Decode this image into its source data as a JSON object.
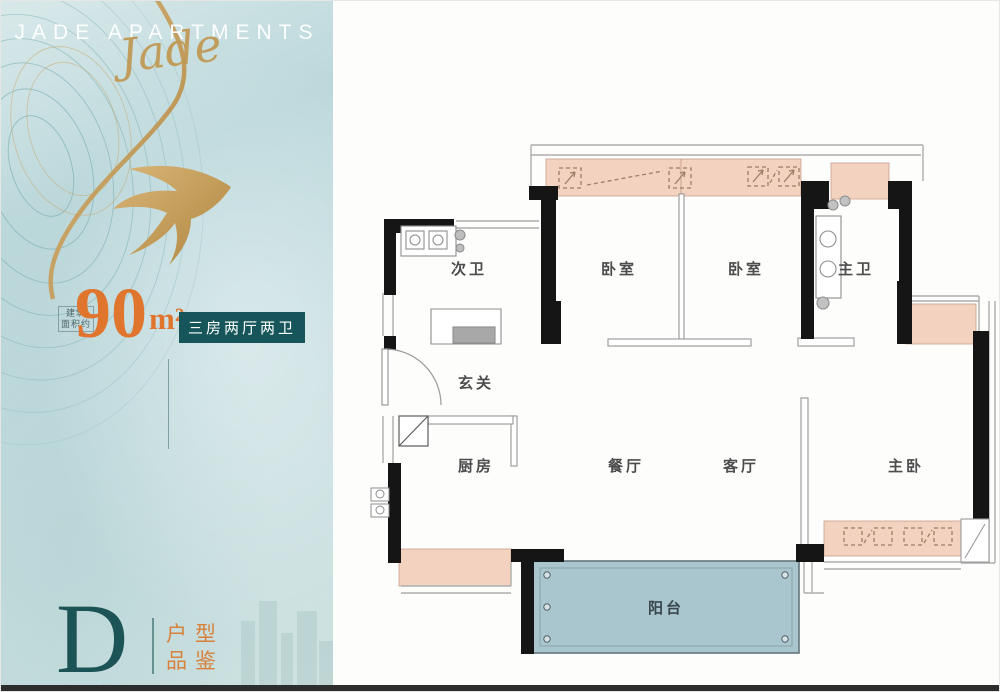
{
  "brand": {
    "title": "JADE APARTMENTS",
    "script": "Jade"
  },
  "area": {
    "prefix": [
      "建筑",
      "面积约"
    ],
    "value": "90",
    "unit": "m²",
    "badge": "三房两厅两卫"
  },
  "unit_card": {
    "letter": "D",
    "label_line1": "户型",
    "label_line2": "品鉴"
  },
  "footnote": "大平层横厅景观阳台，悦享优雅通透格局",
  "plan": {
    "room_labels": [
      "次卫",
      "卧室",
      "卧室",
      "主卫",
      "玄关",
      "厨房",
      "餐厅",
      "客厅",
      "主卧",
      "阳台"
    ]
  },
  "colors": {
    "accent_orange": "#e0752e",
    "badge_teal": "#16565a",
    "gold": "#c09a55",
    "wall_black": "#151515",
    "peach_fill": "#f3d2bf",
    "balcony_blue": "#a9c6cf",
    "panel_blue": "#c3dcdf"
  }
}
